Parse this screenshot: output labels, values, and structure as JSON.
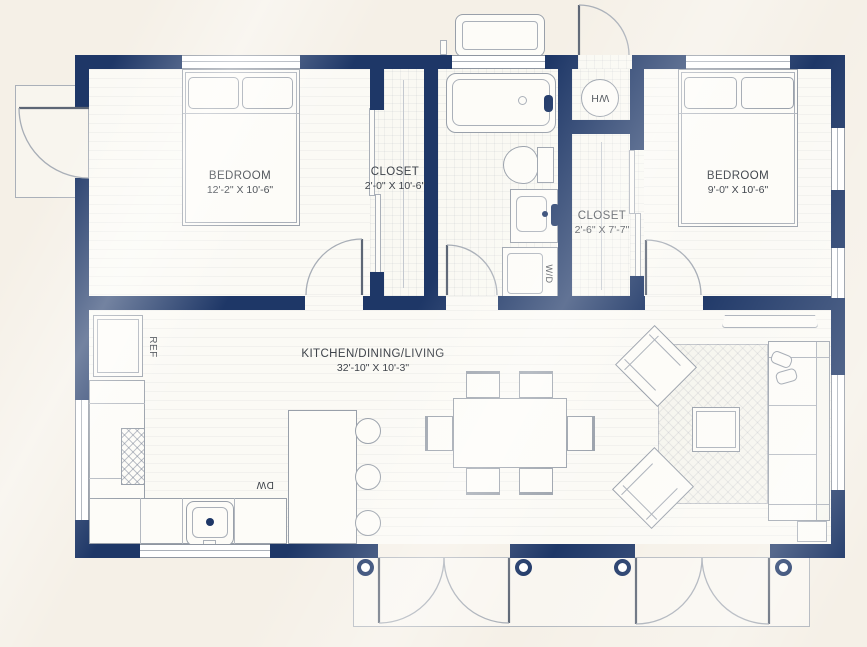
{
  "plan": {
    "rooms": [
      {
        "id": "bedroom-left",
        "name": "BEDROOM",
        "dims": "12'-2\" X 10'-6\""
      },
      {
        "id": "closet-left",
        "name": "CLOSET",
        "dims": "2'-0\" X 10'-6\""
      },
      {
        "id": "bedroom-right",
        "name": "BEDROOM",
        "dims": "9'-0\" X 10'-6\""
      },
      {
        "id": "closet-right",
        "name": "CLOSET",
        "dims": "2'-6\" X 7'-7\""
      },
      {
        "id": "main-room",
        "name": "KITCHEN/DINING/LIVING",
        "dims": "32'-10\" X 10'-3\""
      }
    ],
    "appliances": {
      "water_heater": "WH",
      "refrigerator": "REF",
      "dishwasher": "DW",
      "washer_dryer": "W/D"
    },
    "colors": {
      "wall": "#1e3767",
      "background": "#f5f0e7",
      "floor": "#fbfaf5",
      "line": "#99a0aa"
    }
  }
}
